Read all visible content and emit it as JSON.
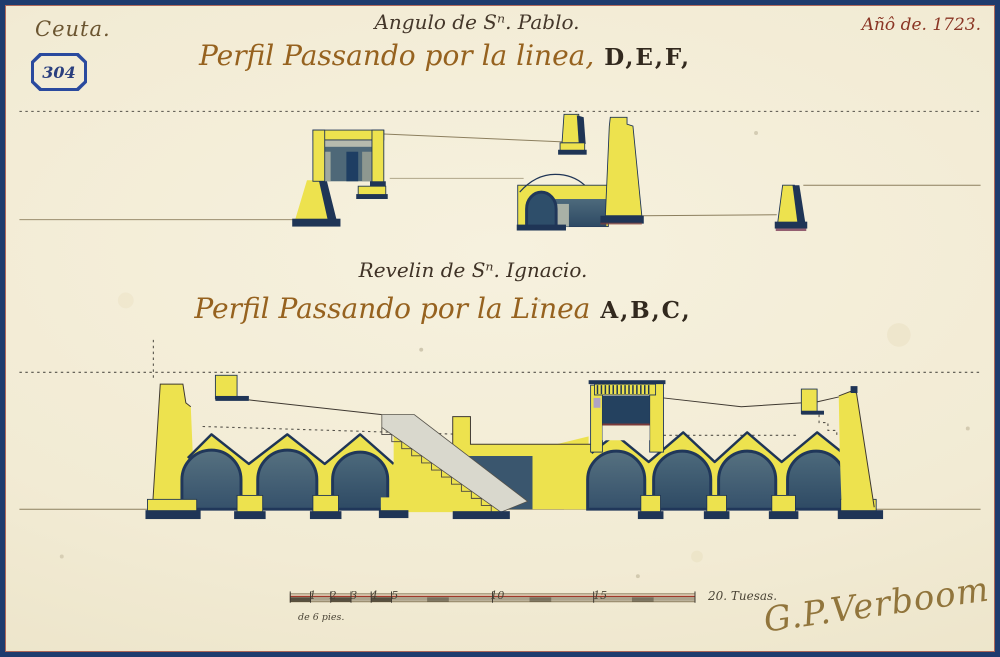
{
  "document": {
    "collection_label": "Ceuta.",
    "stamp_number": "304",
    "year_label": "Añô de. 1723.",
    "upper_profile": {
      "title": "Angulo de Sⁿ. Pablo.",
      "subtitle_script": "Perfil Passando por la linea,",
      "subtitle_letters": "D,E,F,"
    },
    "lower_profile": {
      "title": "Revelin de Sⁿ. Ignacio.",
      "subtitle_script": "Perfil Passando por la Linea",
      "subtitle_letters": "A,B,C,"
    },
    "scale_bar": {
      "marks": [
        "1",
        "2",
        "3",
        "4",
        "5",
        "10",
        "15"
      ],
      "end_label": "20. Tuesas.",
      "unit_note": "de 6 pies."
    },
    "signature": "G.P.Verboom"
  },
  "colors": {
    "paper": "#F3EDD8",
    "masonry_yellow": "#EDE24E",
    "ink_navy": "#1F3556",
    "vault_slate": "#41607A",
    "frame_blue": "#1E3B6E",
    "accent_red": "#A0392A"
  }
}
